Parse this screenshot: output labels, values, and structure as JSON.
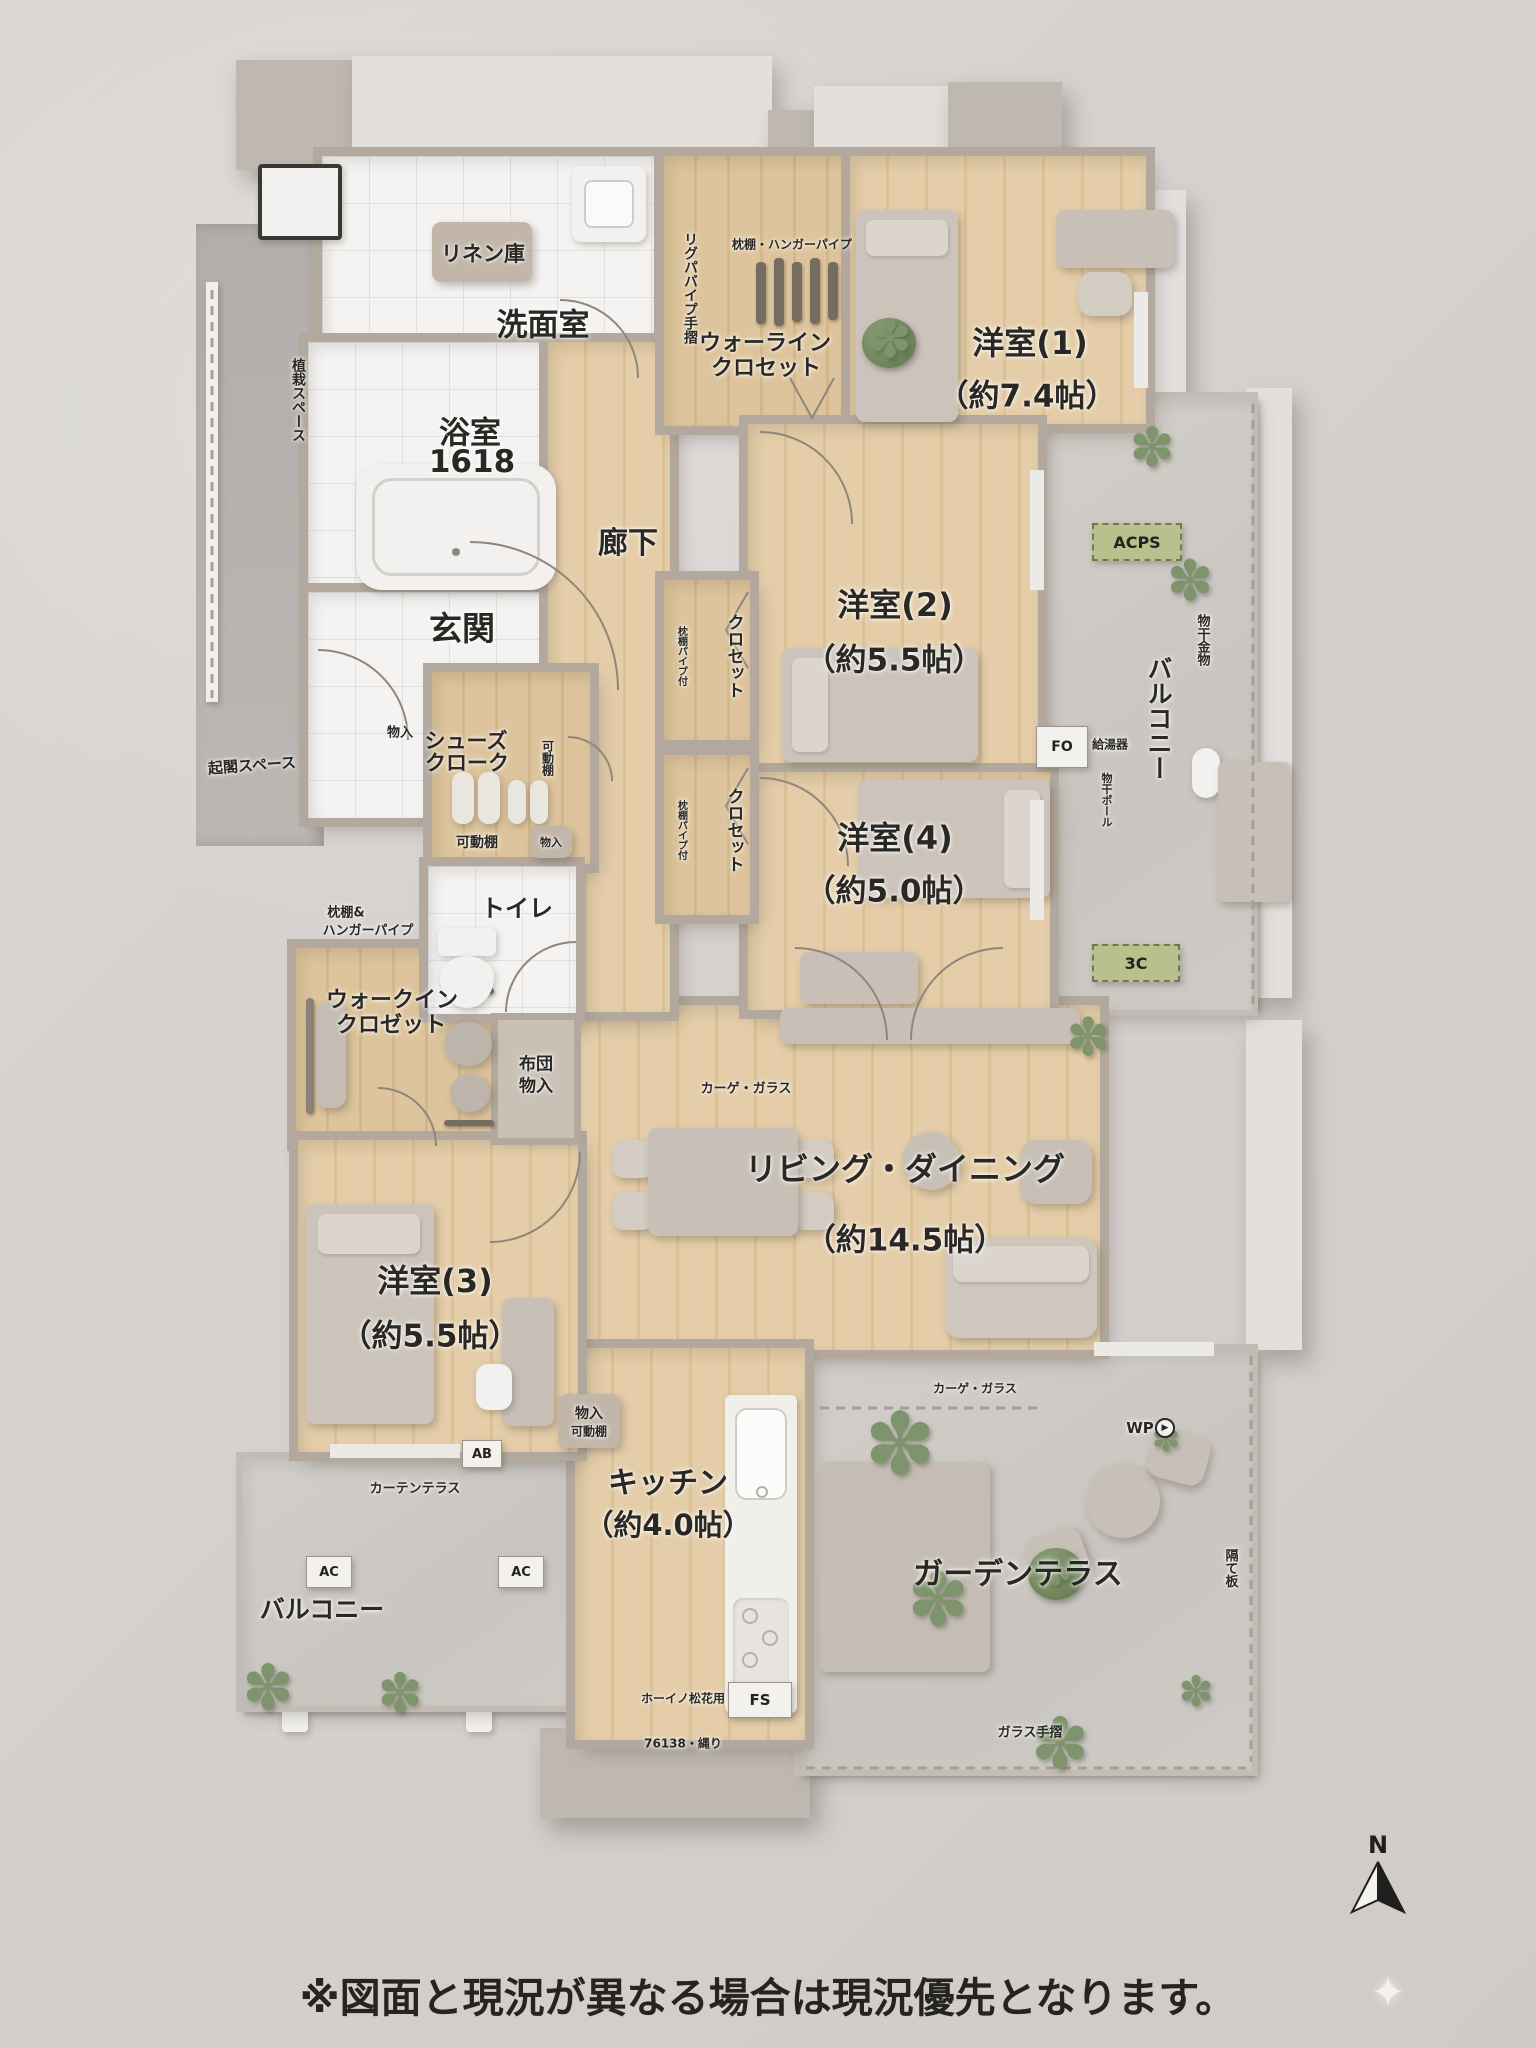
{
  "footer": {
    "disclaimer": "※図面と現況が異なる場合は現況優先となります。"
  },
  "compass": {
    "north": "N"
  },
  "icons": {
    "plant": "✽",
    "sparkle": "✦",
    "wp_arrow": "▶"
  },
  "rooms": {
    "linen": {
      "name": "リネン庫"
    },
    "washroom": {
      "name": "洗面室"
    },
    "bath": {
      "name": "浴室",
      "size": "1618"
    },
    "entrance": {
      "name": "玄関"
    },
    "corridor": {
      "name": "廊下"
    },
    "hall_closet": {
      "line1": "ウォーライン",
      "line2": "クロセット",
      "note": "枕棚・ハンガーパイプ",
      "pillar_note": "リグパバイプ手摺"
    },
    "bedroom1": {
      "name": "洋室(1)",
      "area": "（約7.4帖）"
    },
    "bedroom2": {
      "name": "洋室(2)",
      "area": "（約5.5帖）"
    },
    "bedroom4": {
      "name": "洋室(4)",
      "area": "（約5.0帖）"
    },
    "bedroom3": {
      "name": "洋室(3)",
      "area": "（約5.5帖）"
    },
    "living": {
      "name": "リビング・ダイニング",
      "area": "（約14.5帖）"
    },
    "kitchen": {
      "name": "キッチン",
      "area": "（約4.0帖）"
    },
    "toilet": {
      "name": "トイレ"
    },
    "shoes_cloak": {
      "line1": "シューズ",
      "line2": "クローク",
      "shelf": "可動棚",
      "side_shelf": "可動棚",
      "box": "物入",
      "wall_note": "物入"
    },
    "wic": {
      "line1": "ウォークイン",
      "line2": "クロゼット",
      "note1": "枕棚&",
      "note2": "ハンガーパイプ"
    },
    "futon": {
      "line1": "布団",
      "line2": "物入"
    },
    "balcony_right": {
      "name": "バルコニー",
      "hoshi": "物干金物",
      "kyutoki": "給湯器",
      "pole": "物干ポール"
    },
    "balcony_left": {
      "name": "バルコニー"
    },
    "garden": {
      "name": "ガーデンテラス",
      "divider": "隔て板",
      "glass_rail": "ガラス手摺",
      "glass_top": "カーゲ・ガラス",
      "glass_top2": "カーゲ・ガラス"
    }
  },
  "closets": {
    "a": "クロセット",
    "a_note": "枕棚パイプ付",
    "b": "クロセット",
    "b_note": "枕棚パイプ付"
  },
  "badges": {
    "acps": "ACPS",
    "c3": "3C",
    "fo": "FO",
    "ab": "AB",
    "ac_left": "AC",
    "ac_right": "AC",
    "fs": "FS",
    "wp": "WP"
  },
  "site": {
    "space_top": "植栽スペース",
    "space_mid": "起閣スペース",
    "kitchen_note": "ホーイノ松花用",
    "dim_note": "76138・縄り",
    "curtain_note": "カーテンテラス"
  }
}
